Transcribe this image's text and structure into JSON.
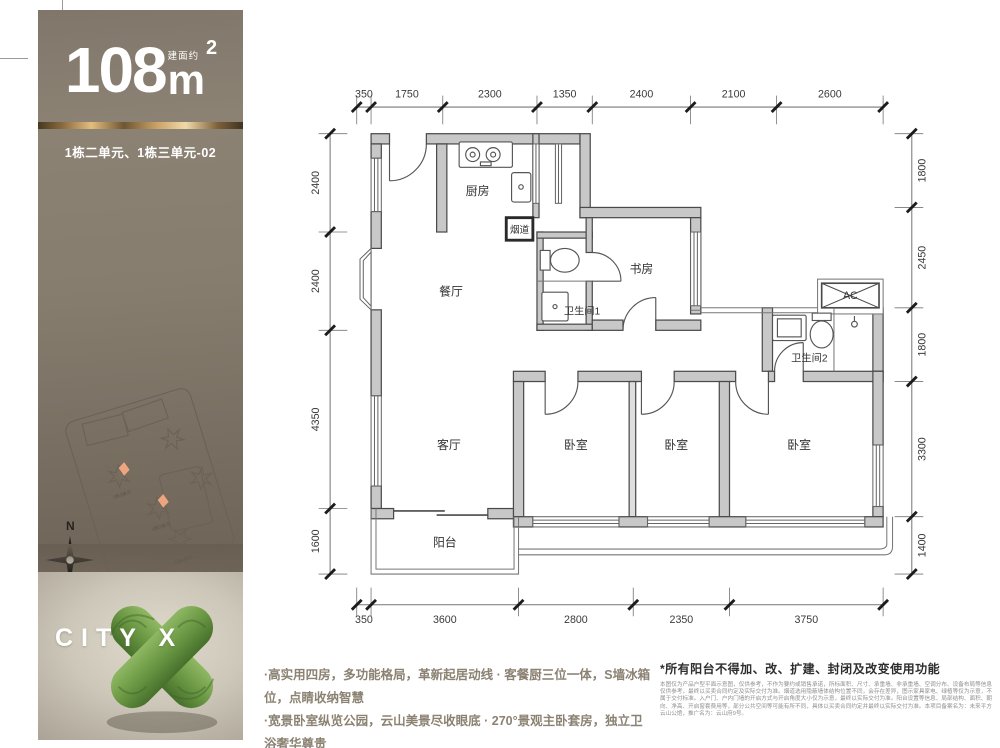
{
  "sidebar": {
    "area_prefix": "建面约",
    "area_number": "108",
    "area_unit": "m",
    "area_sup": "2",
    "unit_label": "1栋二单元、1栋三单元-02",
    "siteplan": {
      "building_labels": [
        "1栋3单元",
        "1栋2单元",
        "1栋1单元"
      ],
      "caption": "平面落位图",
      "compass_label": "N",
      "highlight_color": "#eda57f"
    },
    "logo_text": "CITY X"
  },
  "floorplan": {
    "rooms": [
      {
        "label": "厨房",
        "x": 2950,
        "y": 1500,
        "size": 290
      },
      {
        "label": "烟道",
        "x": 3975,
        "y": 2420,
        "size": 235
      },
      {
        "label": "餐厅",
        "x": 2300,
        "y": 3950,
        "size": 290
      },
      {
        "label": "卫生间1",
        "x": 5500,
        "y": 4420,
        "size": 250
      },
      {
        "label": "书房",
        "x": 6950,
        "y": 3400,
        "size": 290
      },
      {
        "label": "AC",
        "x": 12050,
        "y": 4040,
        "size": 260
      },
      {
        "label": "卫生间2",
        "x": 11050,
        "y": 5560,
        "size": 250
      },
      {
        "label": "客厅",
        "x": 2250,
        "y": 7700,
        "size": 290
      },
      {
        "label": "卧室",
        "x": 5350,
        "y": 7700,
        "size": 290
      },
      {
        "label": "卧室",
        "x": 7800,
        "y": 7700,
        "size": 290
      },
      {
        "label": "卧室",
        "x": 10800,
        "y": 7700,
        "size": 290
      },
      {
        "label": "阳台",
        "x": 2150,
        "y": 10080,
        "size": 290
      }
    ],
    "dimensions": {
      "top": [
        350,
        1750,
        2300,
        1350,
        2400,
        2100,
        2600
      ],
      "bottom": [
        350,
        3600,
        2800,
        2350,
        3750
      ],
      "left": [
        2400,
        2400,
        4350,
        1600
      ],
      "right": [
        1800,
        2450,
        1800,
        3300,
        1400
      ]
    }
  },
  "footer": {
    "selling_points": [
      "·高实用四房，多功能格局，革新起居动线 · 客餐厨三位一体，S墙冰箱位，点睛收纳智慧",
      "·宽景卧室纵览公园，云山美景尽收眼底 · 270°景观主卧套房，独立卫浴奢华尊贵"
    ],
    "disclaimer_title": "*所有阳台不得加、改、扩建、封闭及改变使用功能",
    "disclaimer_body": "本图仅为产品户型平面示意图，仅供参考，不作为要约或销售承诺，所标面积、尺寸、承重墙、非承重墙、空调分布、设备布局等信息仅供参考，最终以买卖合同约定及实际交付为准。烟道选用隐蔽墙体结构位置不同，会存在差异，图示家具家电、绿植等仅为示意，不属于交付标准。入户门、户内门墙的开启方式与开启角度大小仅为示意，最终以实际交付为准。阳台设置等信息、局部结构、面积、朝向、净高、开启窗套费用等，部分公共空间等可能有所不同，具体以买卖合同约定并最终以实际交付为准。本项目备案名为：未来平方云山公馆，推广名为：云山府9号。"
  },
  "colors": {
    "taupe": "#847a6c",
    "gold": "#c9a063",
    "highlight": "#eda57f",
    "wall_fill": "#c8c8c8"
  }
}
